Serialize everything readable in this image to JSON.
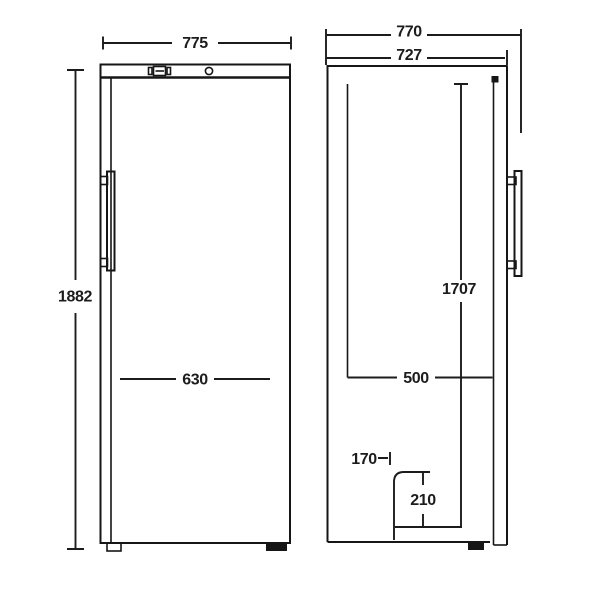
{
  "drawing": {
    "front_view": {
      "width_mm": "775",
      "height_mm": "1882",
      "inner_width_mm": "630"
    },
    "side_view": {
      "depth_with_handle_mm": "770",
      "depth_with_door_mm": "727",
      "door_height_mm": "1707",
      "inner_depth_mm": "500",
      "recess_depth_mm": "170",
      "recess_height_mm": "210"
    }
  }
}
